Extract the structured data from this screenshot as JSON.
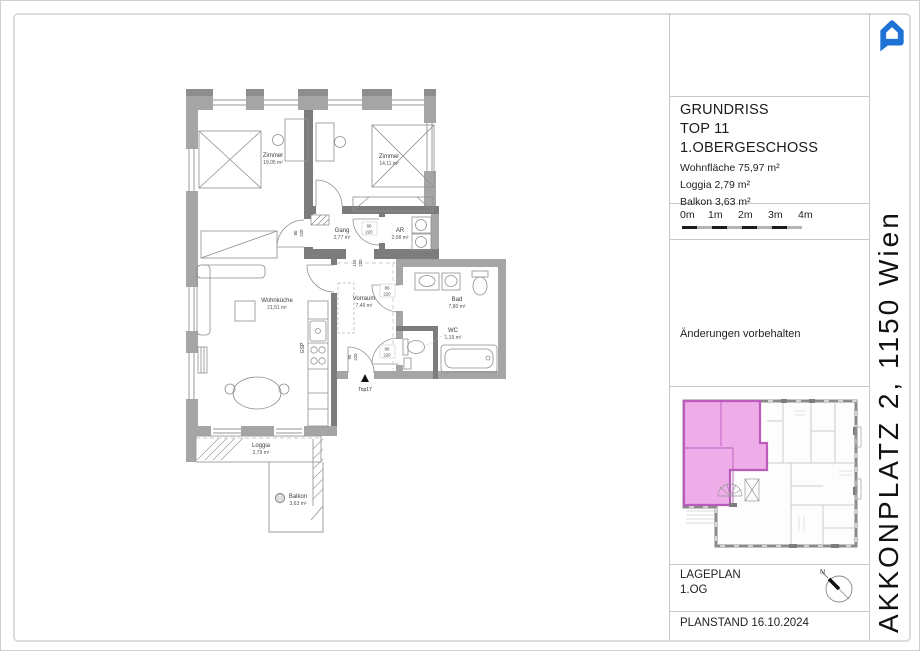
{
  "title_block": {
    "line1": "GRUNDRISS",
    "line2": "TOP 11",
    "line3": "1.OBERGESCHOSS",
    "area1": "Wohnfläche 75,97 m²",
    "area2": "Loggia 2,79 m²",
    "area3": "Balkon 3,63 m²"
  },
  "scale_bar": {
    "labels": [
      "0m",
      "1m",
      "2m",
      "3m",
      "4m"
    ]
  },
  "note": "Änderungen vorbehalten",
  "lageplan_block": {
    "title": "LAGEPLAN",
    "floor": "1.OG"
  },
  "planstand": "PLANSTAND 16.10.2024",
  "address": "AKKONPLATZ 2, 1150 Wien",
  "colors": {
    "logo_blue": "#1e72d4",
    "highlight_pink": "#eeade9",
    "highlight_wall": "#bb5bbb",
    "wall_exterior": "#a5a5a5",
    "wall_interior": "#7c7c7c"
  },
  "plan": {
    "rooms": [
      {
        "name": "Zimmer",
        "area": "19,05 m²"
      },
      {
        "name": "Zimmer",
        "area": "14,11 m²"
      },
      {
        "name": "Gang",
        "area": "2,77 m²"
      },
      {
        "name": "AR",
        "area": "2,08 m²"
      },
      {
        "name": "Wohnküche",
        "area": "21,51 m²"
      },
      {
        "name": "Vorraum",
        "area": "7,46 m²"
      },
      {
        "name": "Bad",
        "area": "7,80 m²"
      },
      {
        "name": "WC",
        "area": "1,19 m²"
      },
      {
        "name": "Loggia",
        "area": "2,79 m²"
      },
      {
        "name": "Balkon",
        "area": "3,63 m²"
      }
    ],
    "dims": [
      {
        "w": "80",
        "h": "220"
      },
      {
        "w": "80",
        "h": "220"
      },
      {
        "w": "110",
        "h": "220"
      },
      {
        "w": "80",
        "h": "220"
      },
      {
        "w": "80",
        "h": "220"
      },
      {
        "w": "90",
        "h": "220"
      }
    ],
    "annotations": {
      "kitchen": "GSP",
      "entrance": "Top17",
      "north": "N"
    }
  }
}
